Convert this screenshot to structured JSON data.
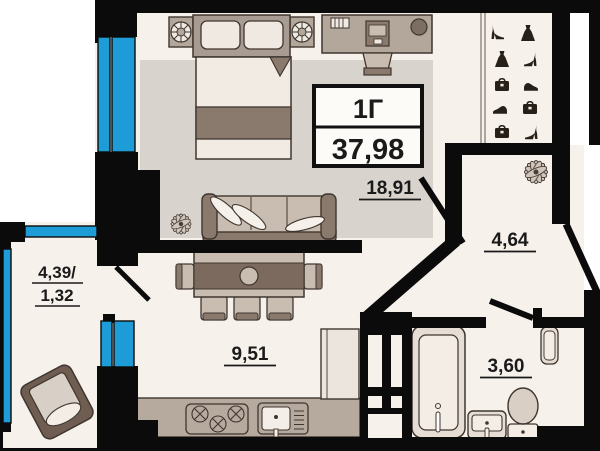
{
  "plan": {
    "unit_label": "1Г",
    "total_area": "37,98",
    "rooms": {
      "living": {
        "name": "living-room",
        "area": "18,91"
      },
      "hall": {
        "name": "hallway",
        "area": "4,64"
      },
      "kitchen": {
        "name": "kitchen",
        "area": "9,51"
      },
      "bathroom": {
        "name": "bathroom",
        "area": "3,60"
      },
      "balcony": {
        "name": "balcony",
        "area_line1": "4,39/",
        "area_line2": "1,32"
      }
    },
    "colors": {
      "wall": "#0b0b0b",
      "window": "#1e9cd8",
      "floor": "#f7f1ec",
      "carpet": "#d9d3ce",
      "furniture_dark": "#8a7a6d",
      "furniture_mid": "#b3a79c",
      "furniture_light": "#f2ebe4",
      "icon": "#262019",
      "text": "#1a1a1a"
    }
  }
}
